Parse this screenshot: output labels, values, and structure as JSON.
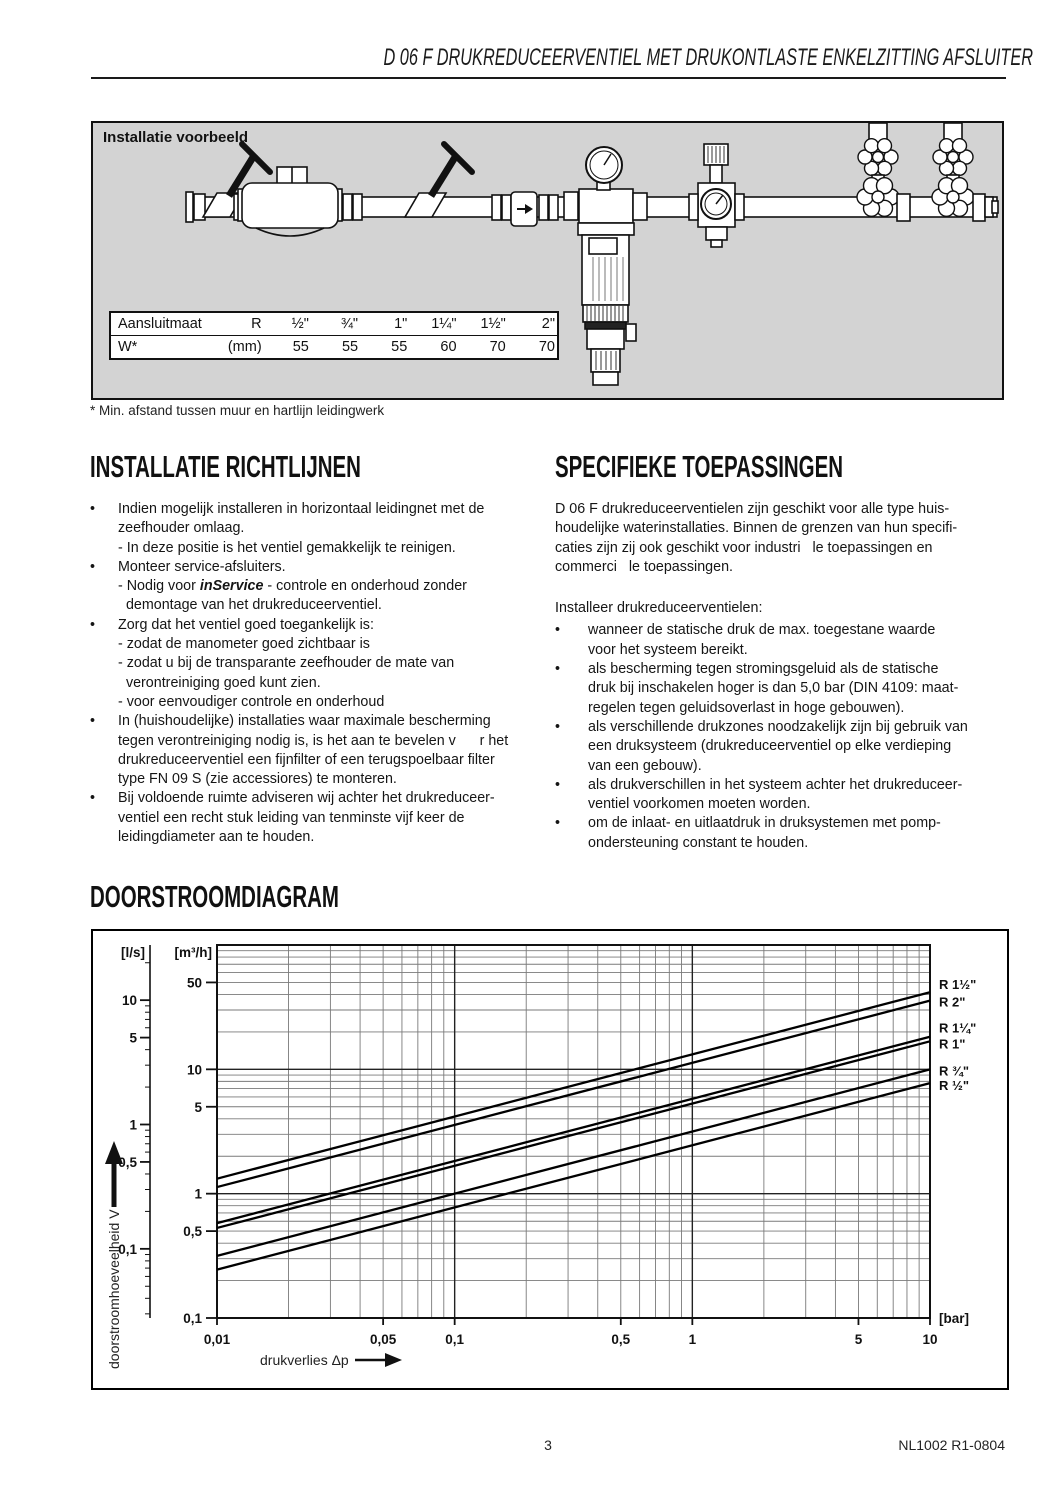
{
  "header": {
    "title": "D 06 F  DRUKREDUCEERVENTIEL MET DRUKONTLASTE ENKELZITTING AFSLUITER"
  },
  "ui": {
    "bullet": "•"
  },
  "colors": {
    "panel_gray": "#d3d3d3",
    "line_black": "#111111"
  },
  "example_box": {
    "label": "Installatie voorbeeld",
    "table": {
      "row1": [
        "Aansluitmaat",
        "R",
        "½\"",
        "¾\"",
        "1\"",
        "1¼\"",
        "1½\"",
        "2\""
      ],
      "row2": [
        "W*",
        "(mm)",
        "55",
        "55",
        "55",
        "60",
        "70",
        "70"
      ]
    },
    "footnote": "* Min. afstand tussen muur en hartlijn leidingwerk"
  },
  "sections": {
    "install": {
      "title": "INSTALLATIE RICHTLIJNEN",
      "bullets": [
        {
          "text": "Indien mogelijk installeren in horizontaal leidingnet met de\nzeefhouder omlaag.\n- In deze positie is het ventiel gemakkelijk te reinigen."
        },
        {
          "pre": "Monteer service-afsluiters.\n- Nodig voor ",
          "em": "inService",
          "post": " - controle en onderhoud zonder\n  demontage van het drukreduceerventiel."
        },
        {
          "text": "Zorg dat het ventiel goed toegankelijk is:\n- zodat de manometer goed zichtbaar is\n- zodat u bij de transparante zeefhouder de mate van\n  verontreiniging goed kunt zien.\n- voor eenvoudiger controle en onderhoud"
        },
        {
          "text": "In (huishoudelijke) installaties waar maximale bescherming\ntegen verontreiniging nodig is, is het aan te bevelen v      r het\ndrukreduceerventiel een fijnfilter of een terugspoelbaar filter\ntype FN 09 S (zie accessiores) te monteren."
        },
        {
          "text": "Bij voldoende ruimte adviseren wij achter het drukreduceer-\nventiel een recht stuk leiding van tenminste vijf keer de\nleidingdiameter aan te houden."
        }
      ]
    },
    "applications": {
      "title": "SPECIFIEKE TOEPASSINGEN",
      "intro": "D 06 F drukreduceerventielen zijn geschikt voor alle type huis-\nhoudelijke waterinstallaties. Binnen de grenzen van hun specifi-\ncaties zijn zij ook geschikt voor industri   le toepassingen en\ncommerci   le toepassingen.",
      "subtitle": "Installeer drukreduceerventielen:",
      "bullets": [
        "wanneer de statische druk de max. toegestane waarde\nvoor het systeem bereikt.",
        "als bescherming tegen stromingsgeluid als de statische\ndruk bij inschakelen hoger is dan 5,0 bar (DIN 4109: maat-\nregelen tegen geluidsoverlast in hoge gebouwen).",
        "als verschillende drukzones noodzakelijk zijn bij gebruik van\neen druksysteem (drukreduceerventiel op elke verdieping\nvan een gebouw).",
        "als drukverschillen in het systeem achter het drukreduceer-\nventiel voorkomen moeten worden.",
        "om de inlaat- en uitlaatdruk in druksystemen met pomp-\nondersteuning constant te houden."
      ]
    }
  },
  "diagram": {
    "title": "DOORSTROOMDIAGRAM"
  },
  "chart_data": {
    "type": "line",
    "title": "DOORSTROOMDIAGRAM",
    "xlabel": "drukverlies Δp",
    "ylabel": "doorstroomhoeveelheid V",
    "x_unit": "[bar]",
    "y_unit_primary": "[m³/h]",
    "y_unit_secondary": "[l/s]",
    "x_scale": "log",
    "y_scale": "log",
    "x_range": [
      0.01,
      10
    ],
    "y_range_m3h": [
      0.1,
      100
    ],
    "grid": "log minor gridlines on",
    "legend_position": "right of plot, at line ends",
    "x_ticks": [
      "0,01",
      "0,05",
      "0,1",
      "0,5",
      "1",
      "5",
      "10"
    ],
    "x_tick_values": [
      0.01,
      0.05,
      0.1,
      0.5,
      1,
      5,
      10
    ],
    "y_ticks_m3h": [
      "50",
      "10",
      "5",
      "1",
      "0,5",
      "0,1"
    ],
    "y_tick_values_m3h": [
      50,
      10,
      5,
      1,
      0.5,
      0.1
    ],
    "y_ticks_ls": [
      "10",
      "5",
      "1",
      "0,5",
      "0,1"
    ],
    "y_tick_values_ls": [
      10,
      5,
      1,
      0.5,
      0.1
    ],
    "ls_to_m3h": 3.6,
    "series": [
      {
        "name": "R 1½\"",
        "points": [
          [
            0.01,
            1.32
          ],
          [
            10,
            41.7
          ]
        ]
      },
      {
        "name": "R 2\"",
        "points": [
          [
            0.01,
            1.13
          ],
          [
            10,
            35.7
          ]
        ]
      },
      {
        "name": "R 1¼\"",
        "points": [
          [
            0.01,
            0.58
          ],
          [
            10,
            18.3
          ]
        ]
      },
      {
        "name": "R 1\"",
        "points": [
          [
            0.01,
            0.53
          ],
          [
            10,
            16.8
          ]
        ]
      },
      {
        "name": "R ¾\"",
        "points": [
          [
            0.01,
            0.316
          ],
          [
            10,
            10.0
          ]
        ]
      },
      {
        "name": "R ½\"",
        "points": [
          [
            0.01,
            0.245
          ],
          [
            10,
            7.75
          ]
        ]
      }
    ]
  },
  "footer": {
    "page": "3",
    "code": "NL1002  R1-0804"
  }
}
